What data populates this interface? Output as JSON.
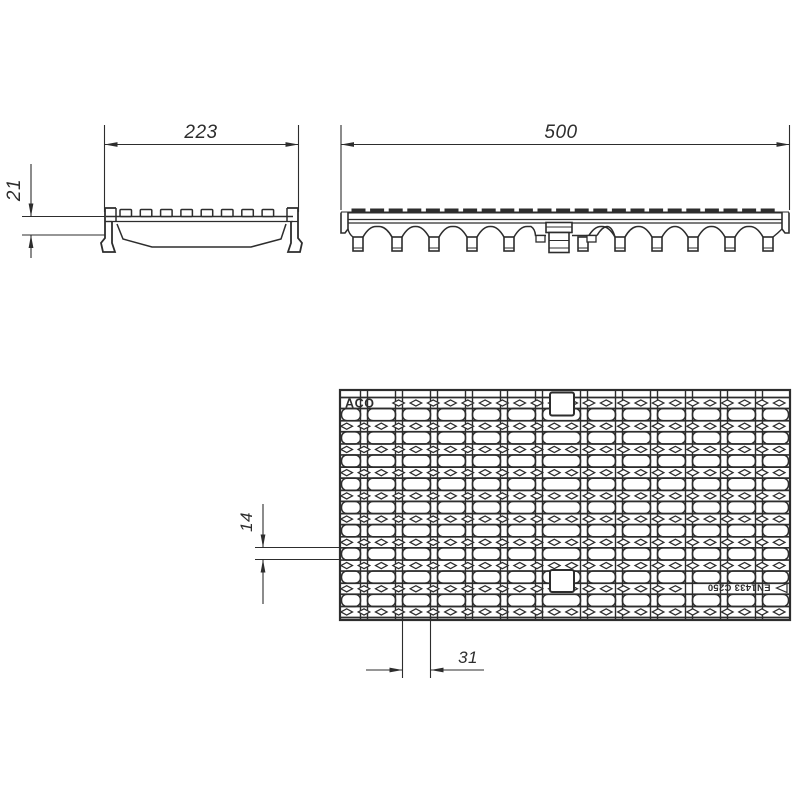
{
  "drawing": {
    "end_view": {
      "width_dim": "223",
      "height_dim": "21"
    },
    "side_view": {
      "length_dim": "500"
    },
    "plan_view": {
      "brand_label": "ACO",
      "standard_label": "EN1433 C250",
      "slot_height_dim": "14",
      "slot_width_dim": "31"
    },
    "colors": {
      "line": "#2d2d2d",
      "background": "#ffffff"
    }
  }
}
